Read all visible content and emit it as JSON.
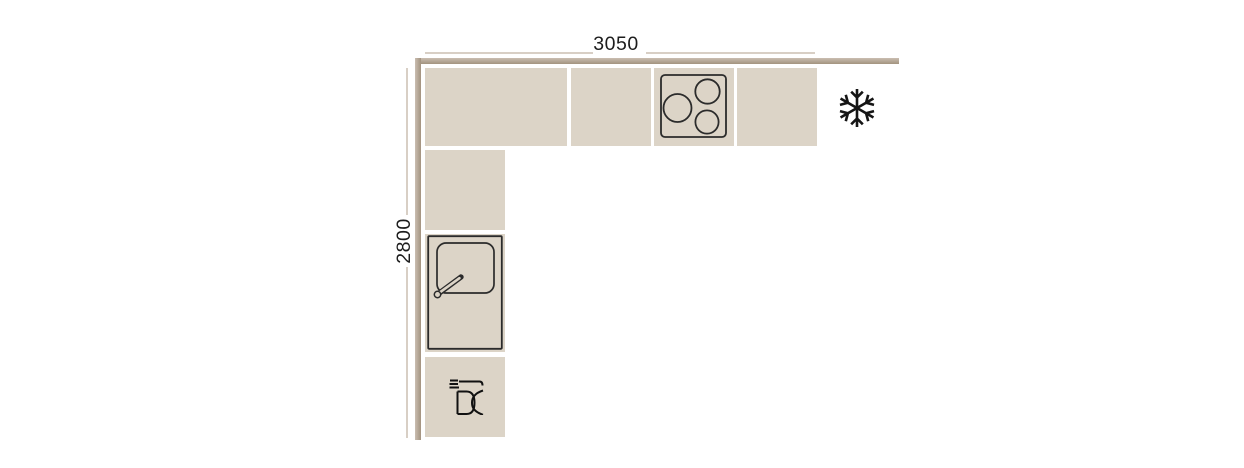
{
  "dimensions": {
    "width": {
      "label": "3050"
    },
    "depth": {
      "label": "2800"
    }
  },
  "fixtures": {
    "cooktop": {
      "icon": "cooktop-burners-icon",
      "burners": 3
    },
    "sink": {
      "icon": "sink-with-faucet-icon"
    },
    "dishwasher": {
      "icon": "dishwasher-icon"
    },
    "freezer": {
      "icon": "snowflake-icon"
    }
  },
  "layout_units": {
    "top_row_cabinets": 4,
    "left_column_cabinets": 3
  },
  "colors": {
    "cabinet_fill": "#dcd4c7",
    "wall_dark": "#a2937f",
    "wall_light": "#cabdb1",
    "dimension_line": "#d8cfc5",
    "outline_stroke": "#2b2b2b",
    "icon_stroke": "#111111",
    "text": "#1c1c1c",
    "background": "#ffffff"
  }
}
